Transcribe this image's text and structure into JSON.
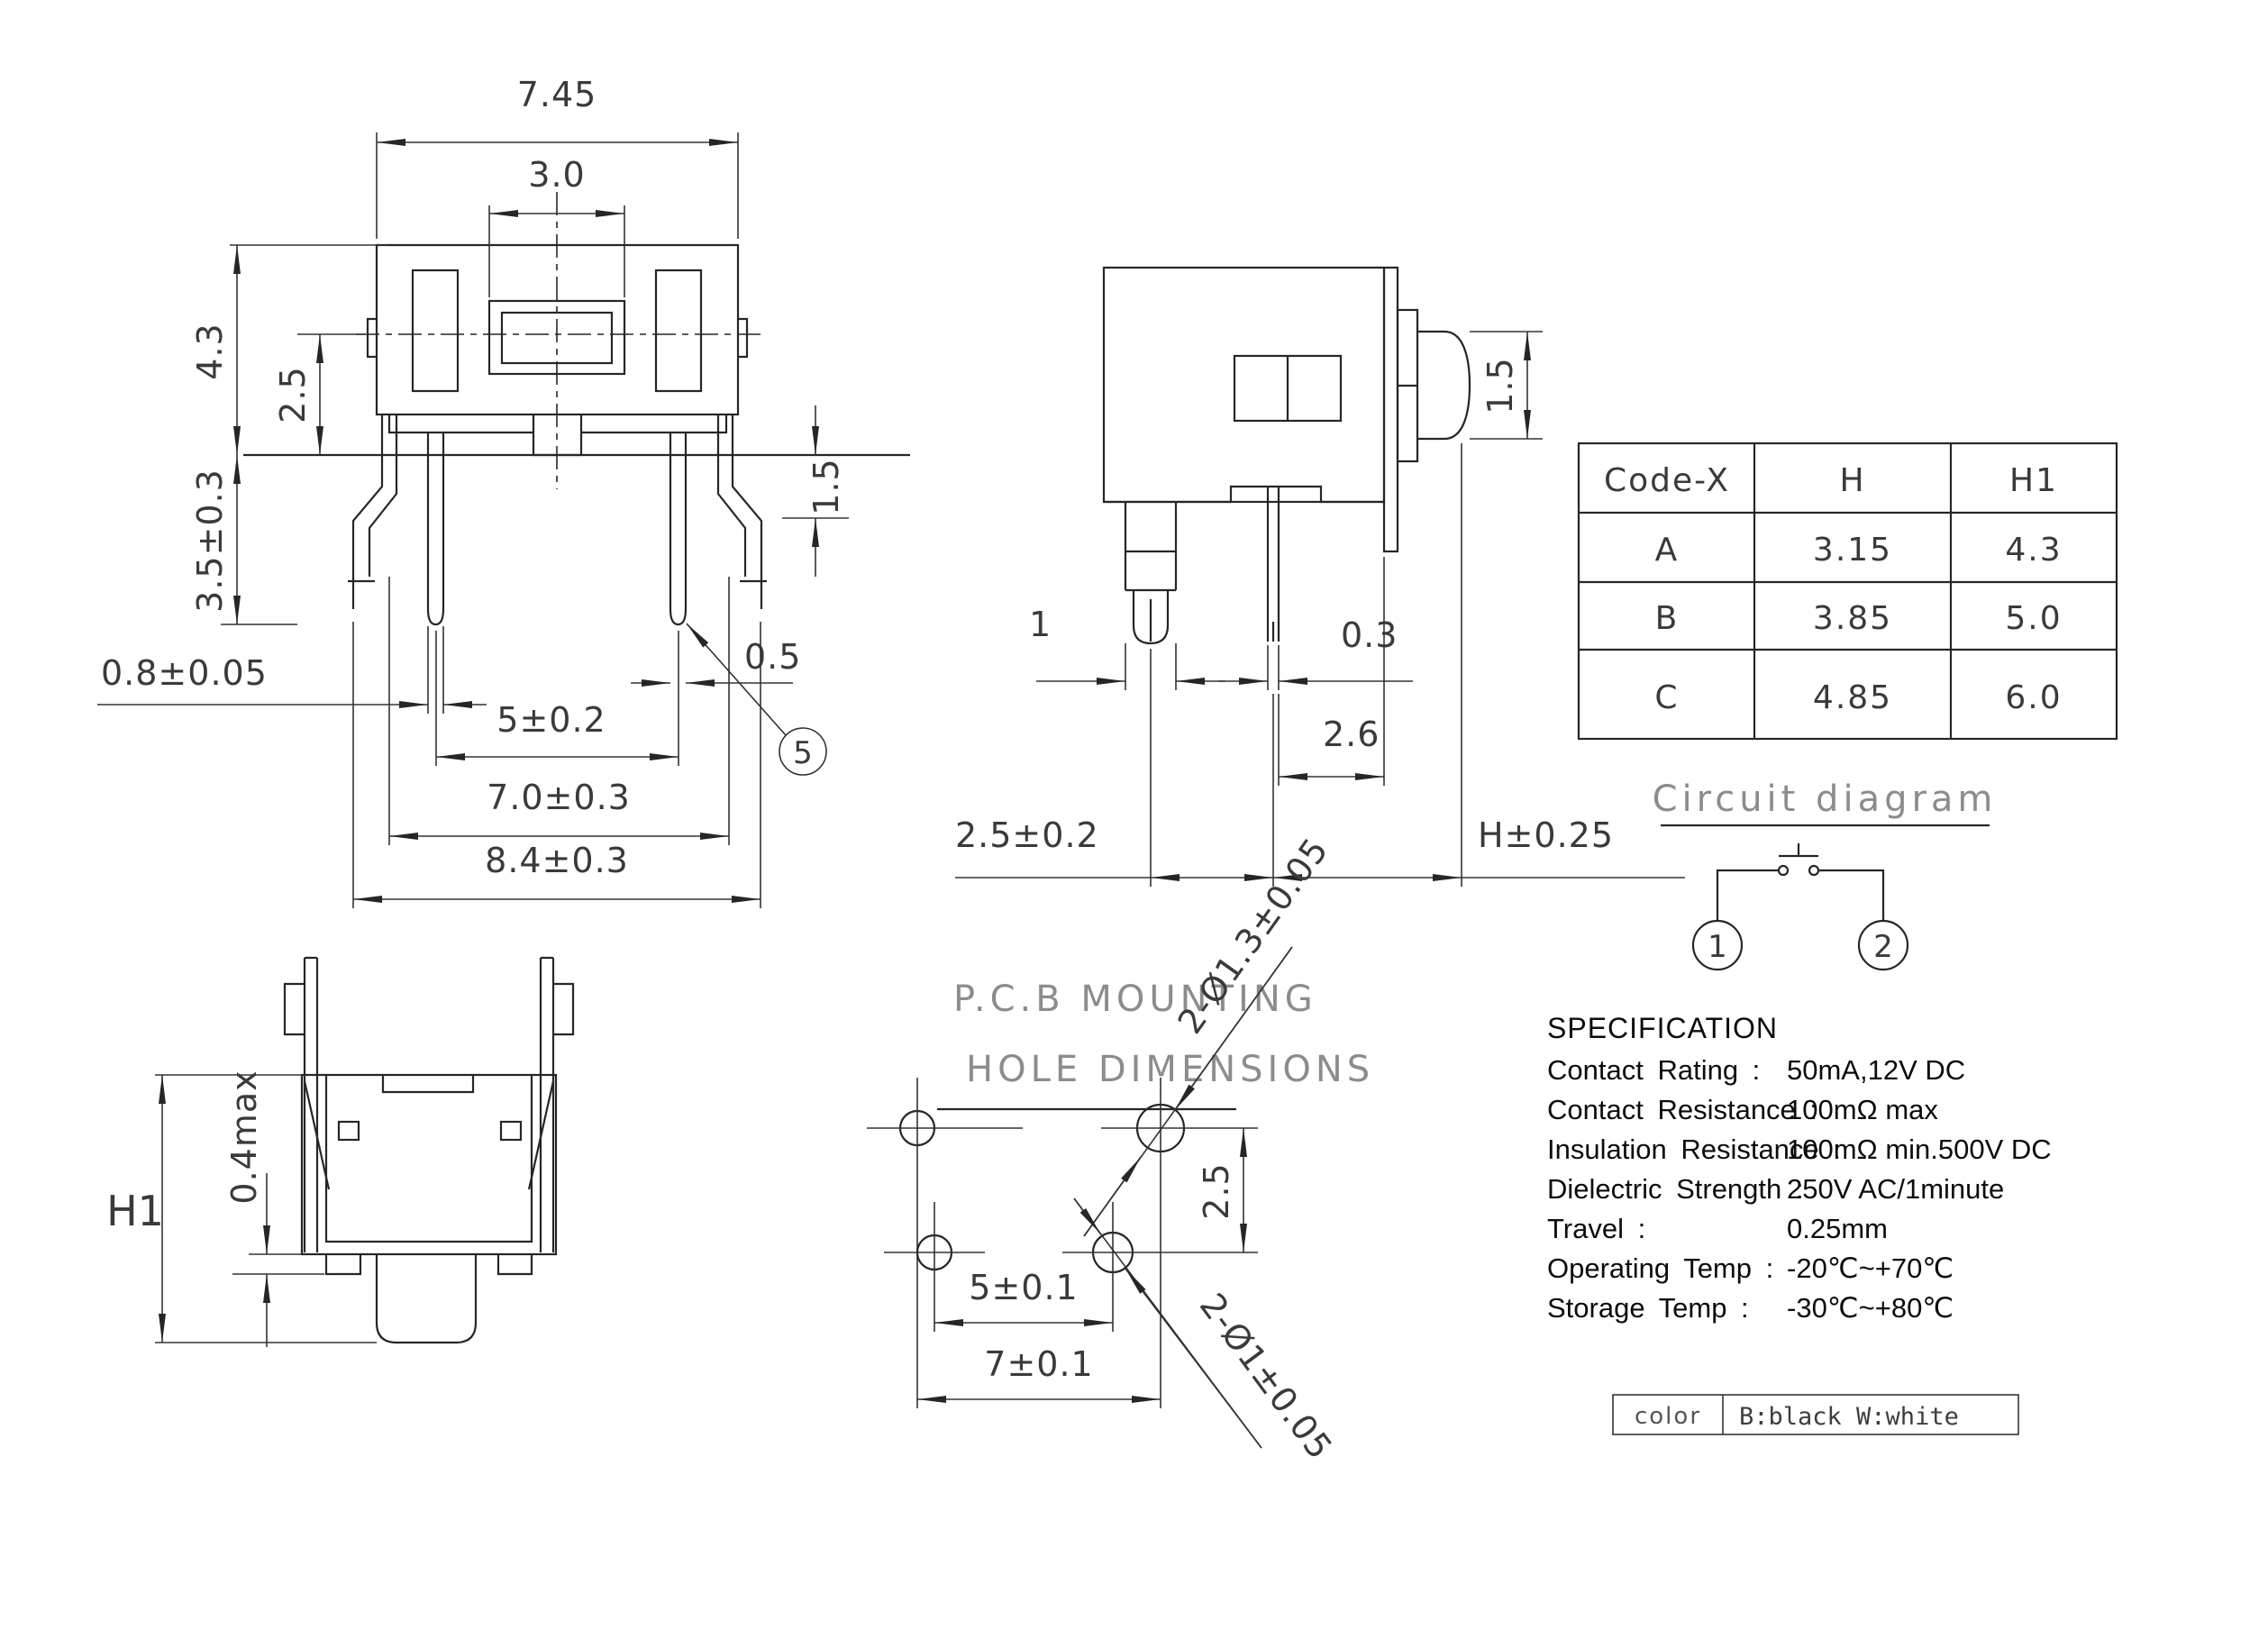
{
  "front_view": {
    "dims": {
      "overall_width": "7.45",
      "button_width": "3.0",
      "height": "4.3",
      "center_height": "2.5",
      "lead_length": "3.5±0.3",
      "bend_drop": "1.5",
      "pin_width": "0.8±0.05",
      "pin_tip": "0.5",
      "pin_pitch": "5±0.2",
      "outer_pitch": "7.0±0.3",
      "outer_span": "8.4±0.3",
      "balloon": "5"
    }
  },
  "side_view": {
    "dims": {
      "plunger_dia": "1.5",
      "lead_width": "1",
      "pin_thickness": "0.3",
      "pin_offset": "2.6",
      "lead_offset": "2.5±0.2",
      "height": "H±0.25"
    }
  },
  "bottom_view": {
    "dims": {
      "height": "H1",
      "standoff": "0.4max"
    }
  },
  "pcb_view": {
    "title_line1": "P.C.B MOUNTING",
    "title_line2": "HOLE DIMENSIONS",
    "dims": {
      "hole_large": "2-Ø1.3±0.05",
      "hole_small": "2-Ø1±0.05",
      "row_gap": "2.5",
      "pitch5": "5±0.1",
      "pitch7": "7±0.1"
    }
  },
  "code_table": {
    "headers": [
      "Code-X",
      "H",
      "H1"
    ],
    "rows": [
      [
        "A",
        "3.15",
        "4.3"
      ],
      [
        "B",
        "3.85",
        "5.0"
      ],
      [
        "C",
        "4.85",
        "6.0"
      ]
    ]
  },
  "circuit": {
    "title": "Circuit diagram",
    "pin1": "1",
    "pin2": "2"
  },
  "spec": {
    "title": "SPECIFICATION",
    "rows": [
      {
        "label": "Contact  Rating :",
        "value": "50mA,12V DC"
      },
      {
        "label": "Contact  Resistance :",
        "value": "100mΩ max"
      },
      {
        "label": "Insulation Resistance :",
        "value": "100mΩ min.500V DC"
      },
      {
        "label": "Dielectric  Strength :",
        "value": "250V AC/1minute"
      },
      {
        "label": "Travel :",
        "value": "0.25mm"
      },
      {
        "label": "Operating Temp :",
        "value": "-20℃~+70℃"
      },
      {
        "label": "Storage Temp :",
        "value": "-30℃~+80℃"
      }
    ]
  },
  "color_table": {
    "label": "color",
    "value": "B:black W:white"
  }
}
